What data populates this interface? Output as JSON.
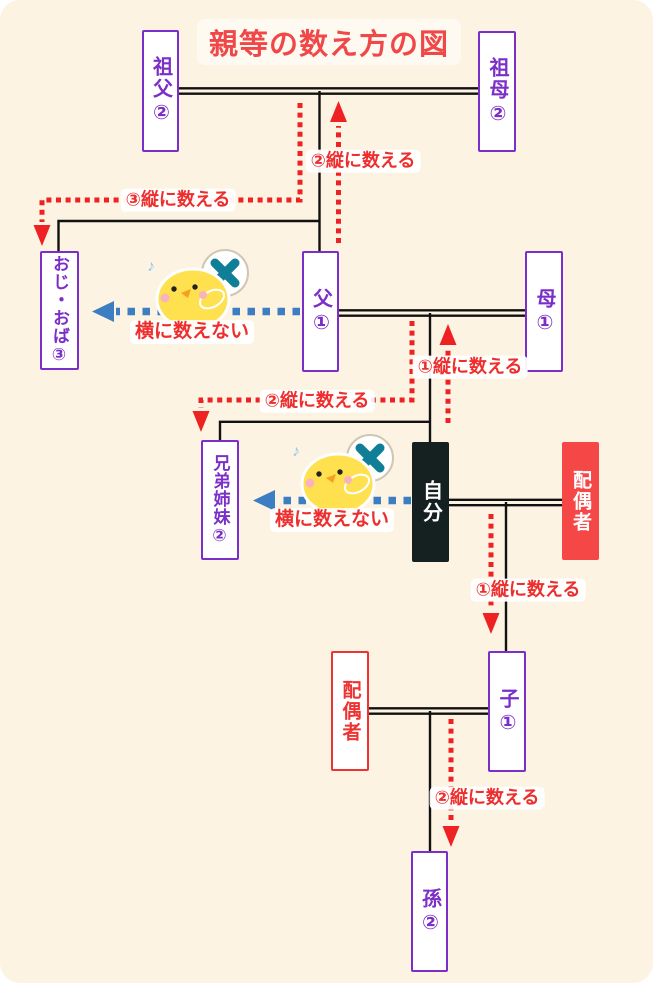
{
  "title": "親等の数え方の図",
  "nodes": {
    "sofu": {
      "label": "祖父②"
    },
    "sobo": {
      "label": "祖母②"
    },
    "ojioba": {
      "label": "おじ・おば③"
    },
    "chichi": {
      "label": "父①"
    },
    "haha": {
      "label": "母①"
    },
    "kyodai": {
      "label": "兄弟姉妹②"
    },
    "jibun": {
      "label": "自分"
    },
    "haigusha_jibun": {
      "label": "配偶者"
    },
    "haigusha_ko": {
      "label": "配偶者"
    },
    "ko": {
      "label": "子①"
    },
    "mago": {
      "label": "孫②"
    }
  },
  "flow_labels": {
    "count2_top": "②縦に数える",
    "count3_top": "③縦に数える",
    "count1_parent": "①縦に数える",
    "count2_sibling": "②縦に数える",
    "count1_child": "①縦に数える",
    "count2_grandchild": "②縦に数える",
    "no_horizontal_upper": "横に数えない",
    "no_horizontal_lower": "横に数えない"
  },
  "icons": {
    "mascot": "chick-with-x-sign-icon",
    "sign": "x-mark-sign-icon",
    "music_note": "♪"
  },
  "colors": {
    "background": "#fcf3e2",
    "node_purple": "#7b2fc8",
    "accent_red": "#ee3333",
    "title_red": "#f04848",
    "self_black": "#152020",
    "spouse_red_fill": "#f64747",
    "arrow_blue": "#3d7ec2",
    "sign_x_teal": "#0f7e96",
    "line_black": "#111111",
    "chick_yellow": "#ffe04e"
  }
}
